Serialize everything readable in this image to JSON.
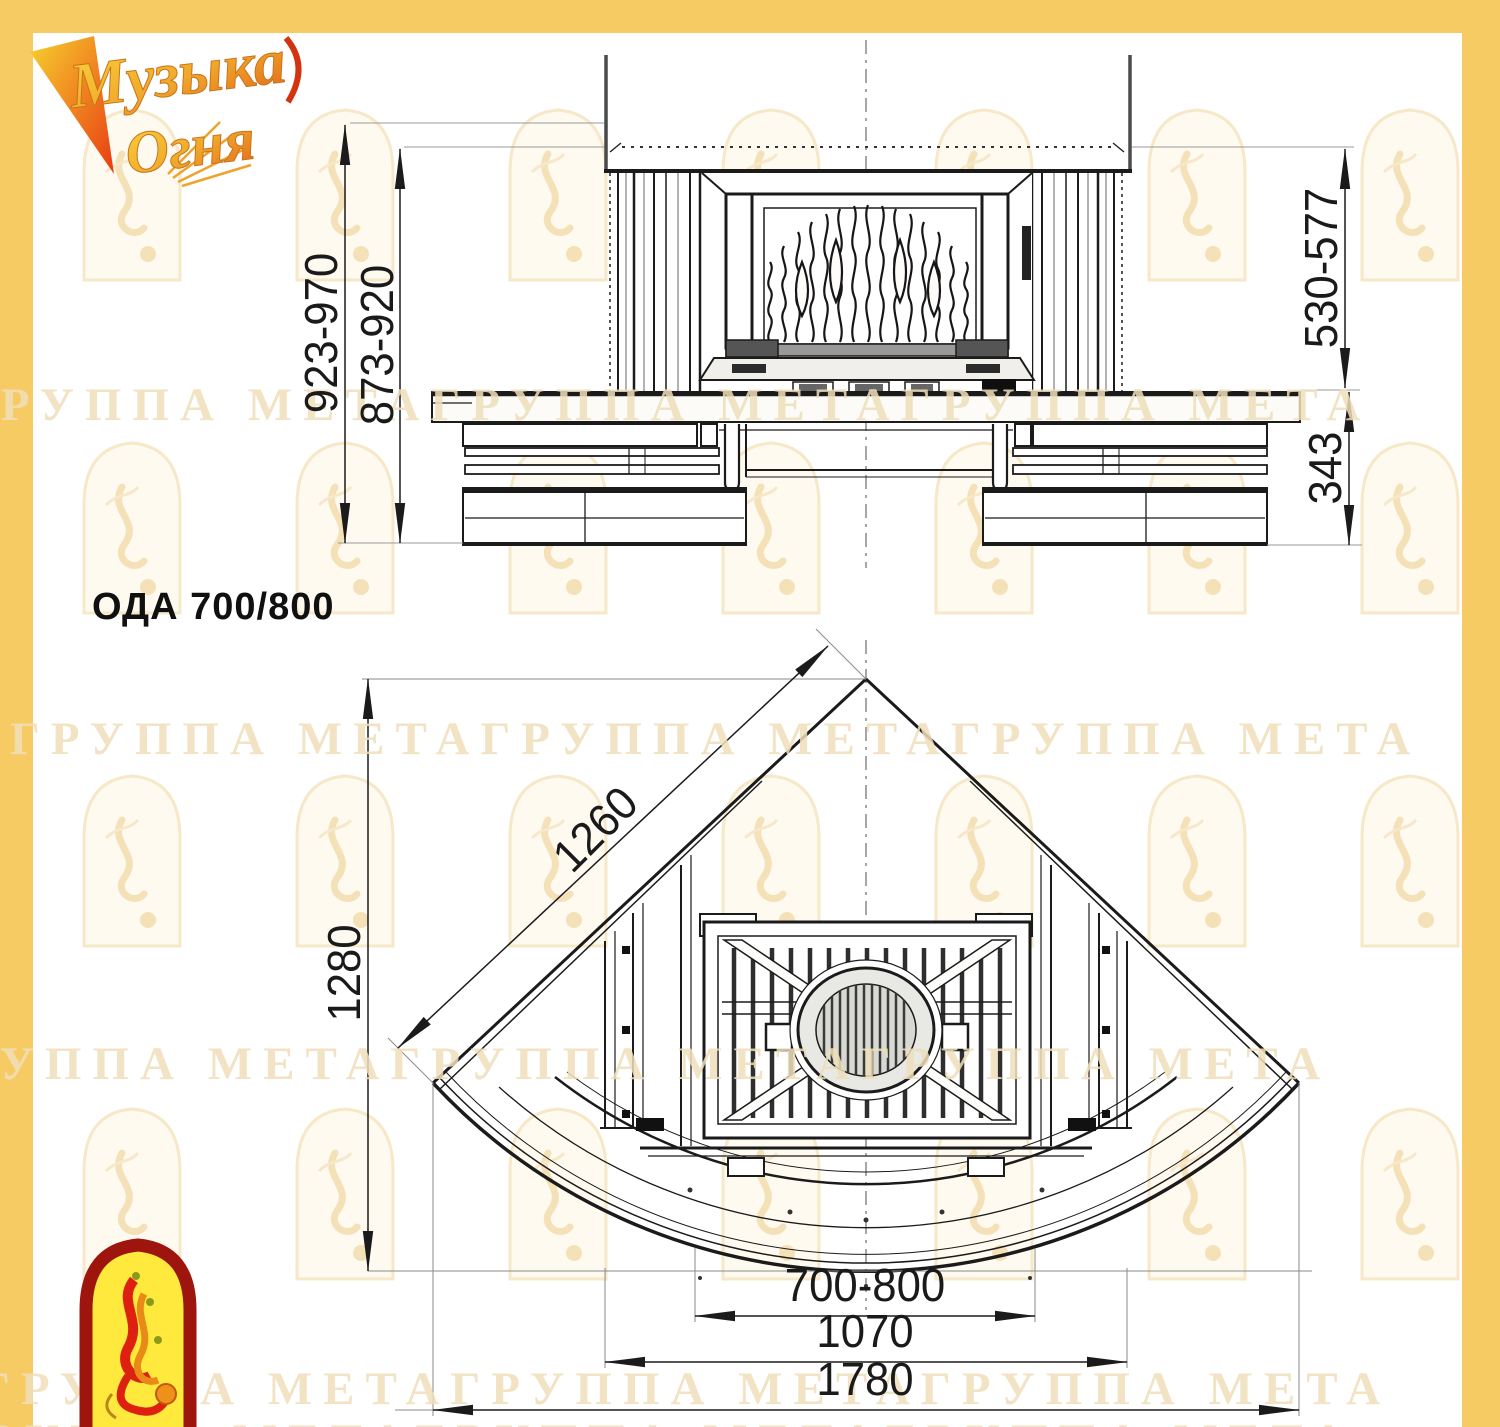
{
  "colors": {
    "frame_yellow": "#F7CB64",
    "ink": "#1b1b1b",
    "watermark": "#EFDFBA",
    "badge_yellow": "#FFE93D",
    "badge_red": "#9E150E",
    "logo_gold": "#F0A82A"
  },
  "brand": {
    "name_line1": "Музыка",
    "name_line2": "Огня"
  },
  "title": "ОДА 700/800",
  "watermark_text": "ГРУППА МЕТАГРУППА МЕТАГРУППА МЕТА",
  "front_view": {
    "dims": {
      "overall_height": "923-970",
      "body_height": "873-920",
      "firebox_height": "530-577",
      "base_height": "343"
    }
  },
  "plan_view": {
    "dims": {
      "wall_length": "1260",
      "depth": "1280",
      "opening_width": "700-800",
      "inner_width": "1070",
      "overall_width": "1780"
    }
  }
}
